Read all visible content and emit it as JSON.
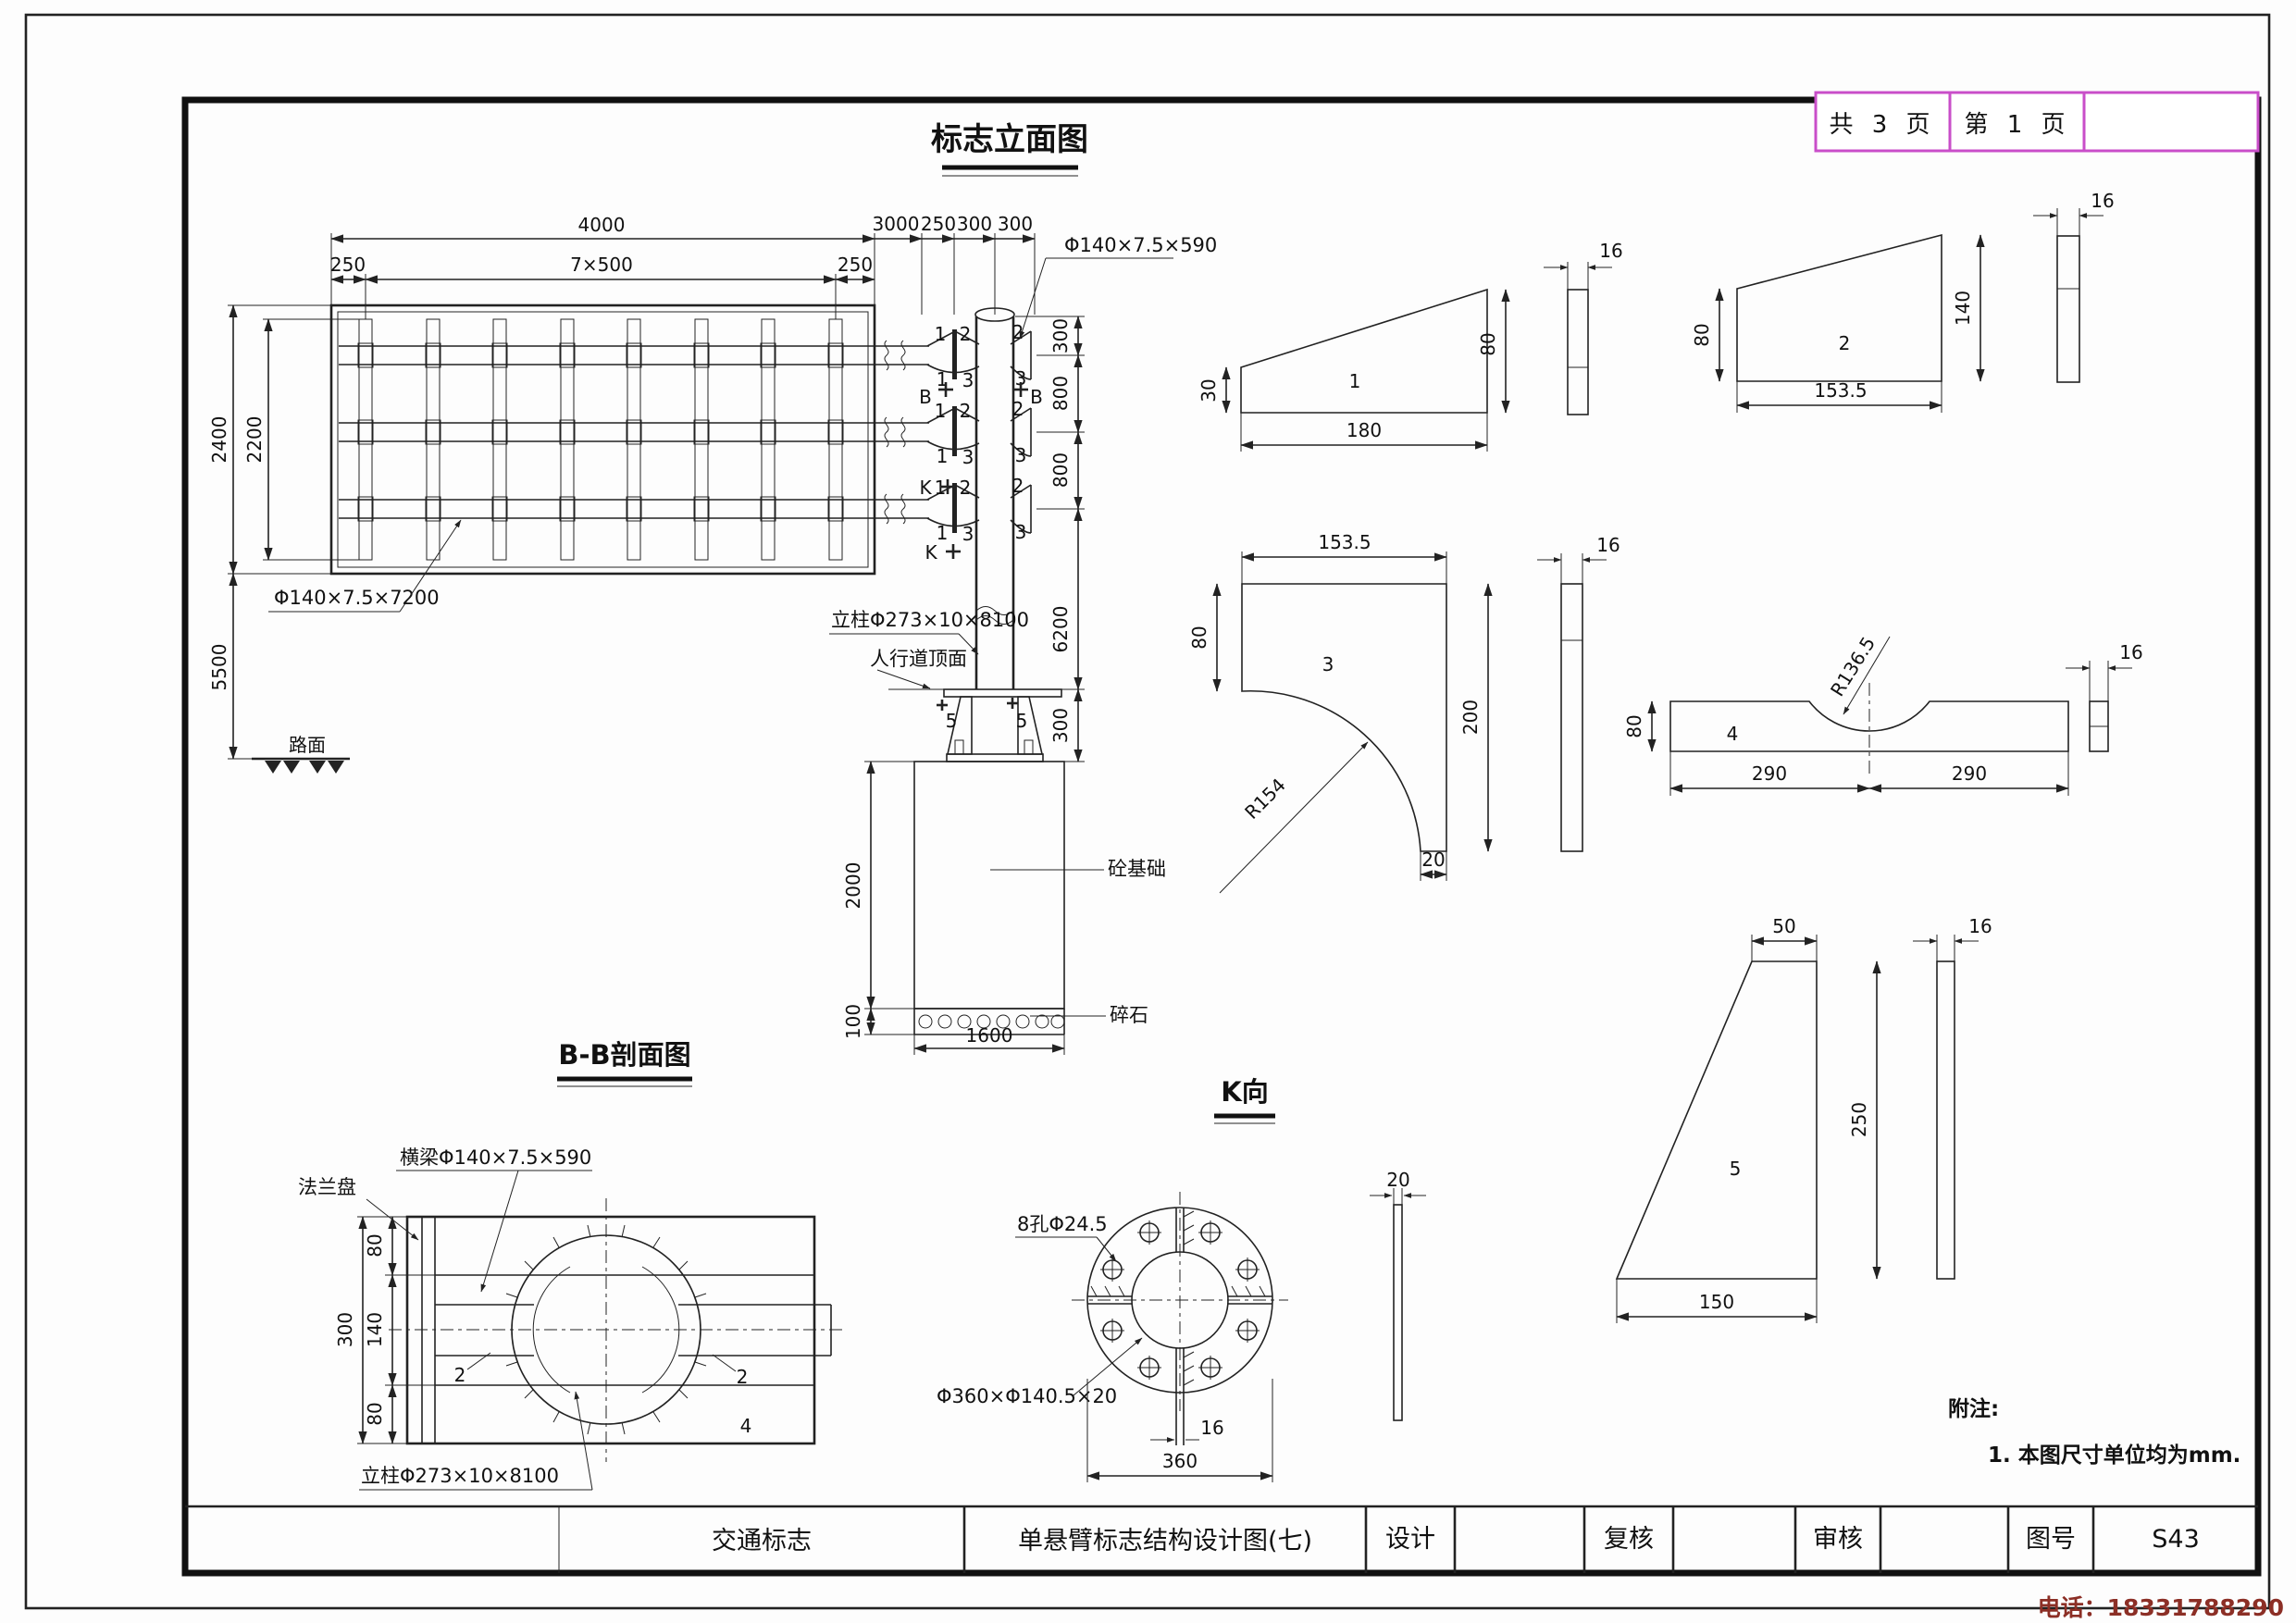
{
  "page_box": {
    "total": "共 3 页",
    "current": "第 1 页"
  },
  "titles": {
    "elevation": "标志立面图",
    "section_bb": "B-B剖面图",
    "view_k": "K向"
  },
  "titlebar": {
    "category": "交通标志",
    "drawing_title": "单悬臂标志结构设计图(七)",
    "design_label": "设计",
    "recheck_label": "复核",
    "review_label": "审核",
    "figno_label": "图号",
    "figno_value": "S43"
  },
  "notes": {
    "title": "附注:",
    "item1": "1. 本图尺寸单位均为mm."
  },
  "footer": {
    "phone": "电话：18331788290"
  },
  "labels": {
    "panel_beam": "Φ140×7.5×7200",
    "arm_beam": "Φ140×7.5×590",
    "column": "立柱Φ273×10×8100",
    "sidewalk_top": "人行道顶面",
    "road_surface": "路面",
    "concrete_foundation": "砼基础",
    "gravel": "碎石",
    "cross_beam": "横梁Φ140×7.5×590",
    "flange_plate": "法兰盘",
    "bolt_holes": "8孔Φ24.5",
    "flange_ring": "Φ360×Φ140.5×20"
  },
  "dims": {
    "d4000": "4000",
    "d3000": "3000",
    "d250": "250",
    "d300": "300",
    "d7x500": "7×500",
    "d2400": "2400",
    "d2200": "2200",
    "d5500": "5500",
    "d800": "800",
    "d6200": "6200",
    "d2000": "2000",
    "d100": "100",
    "d1600": "1600",
    "d180": "180",
    "d30": "30",
    "d80": "80",
    "d16": "16",
    "d153_5": "153.5",
    "d140": "140",
    "d200": "200",
    "d20": "20",
    "dR154": "R154",
    "dR136_5": "R136.5",
    "d290": "290",
    "d50": "50",
    "d150": "150",
    "d360": "360"
  },
  "parts": {
    "p1": "1",
    "p2": "2",
    "p3": "3",
    "p4": "4",
    "p5": "5"
  },
  "marks": {
    "b": "B",
    "k": "K"
  }
}
